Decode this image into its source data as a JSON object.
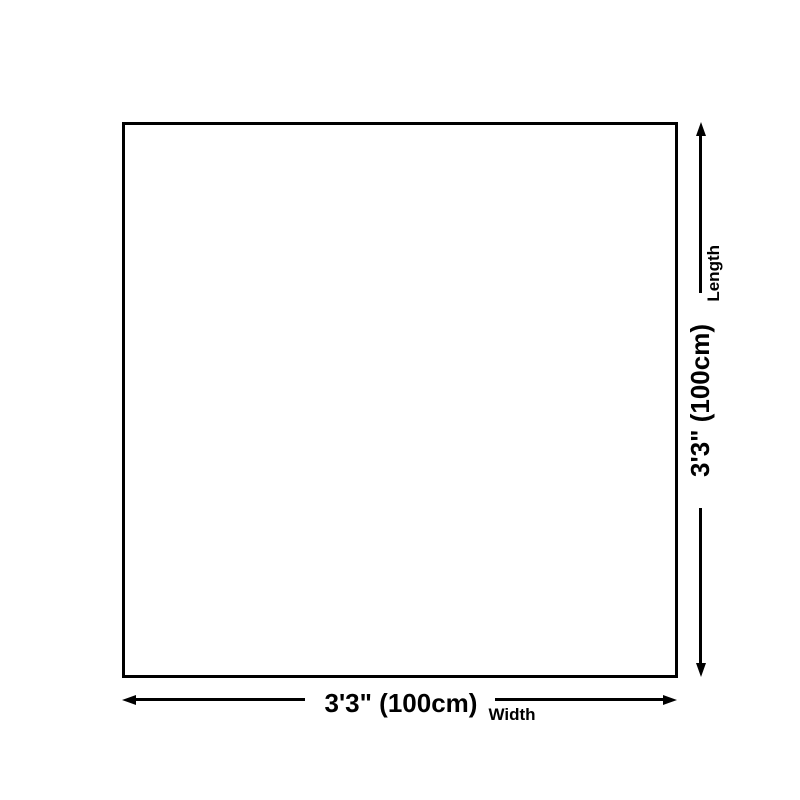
{
  "colors": {
    "background": "#ffffff",
    "line": "#000000",
    "text": "#000000"
  },
  "dim_length": {
    "value": "3'3\" (100cm)",
    "label": "Length"
  },
  "dim_width": {
    "value": "3'3\" (100cm)",
    "label": "Width"
  }
}
